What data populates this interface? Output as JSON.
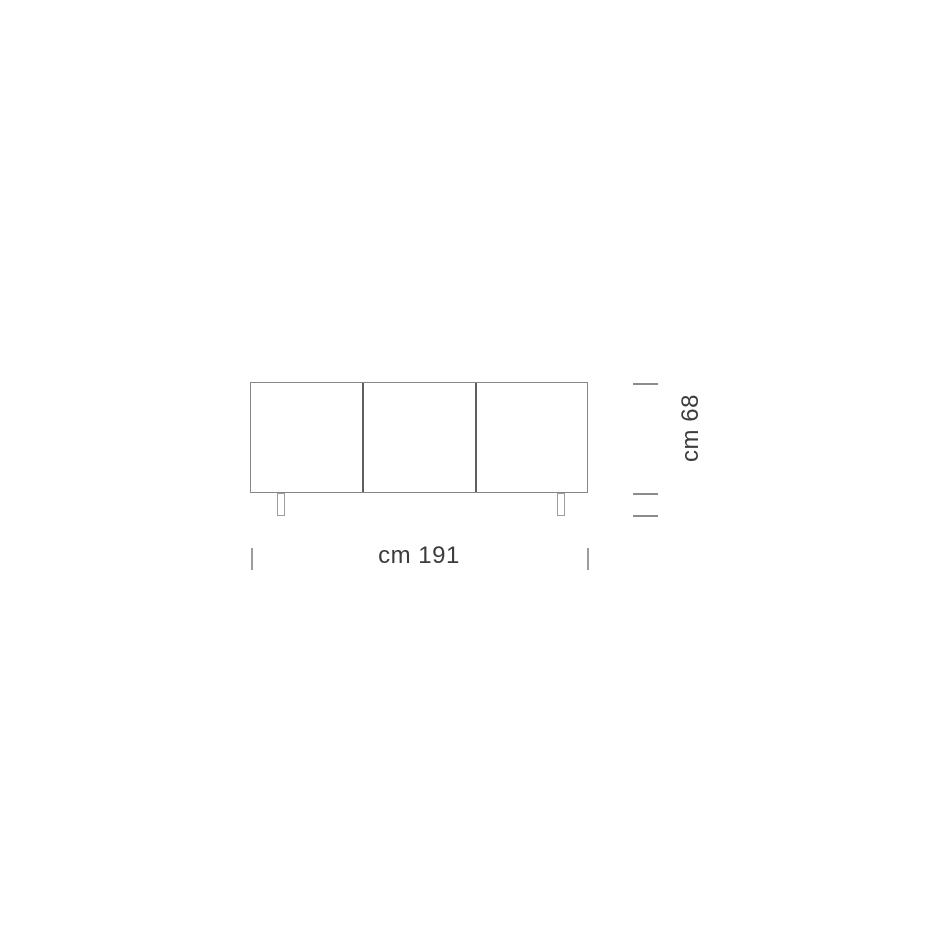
{
  "diagram": {
    "type": "furniture-front-elevation",
    "door_count": 3,
    "dimensions": {
      "width_label": "cm 191",
      "height_label": "cm 68"
    },
    "colors": {
      "background": "#ffffff",
      "cabinet_outline": "#868686",
      "door_divider": "#5f5f5f",
      "leg_outline": "#9e9e9e",
      "height_tick": "#8c8c8c",
      "width_tick": "#9c9c9c",
      "label_text": "#3c3c3c"
    }
  }
}
